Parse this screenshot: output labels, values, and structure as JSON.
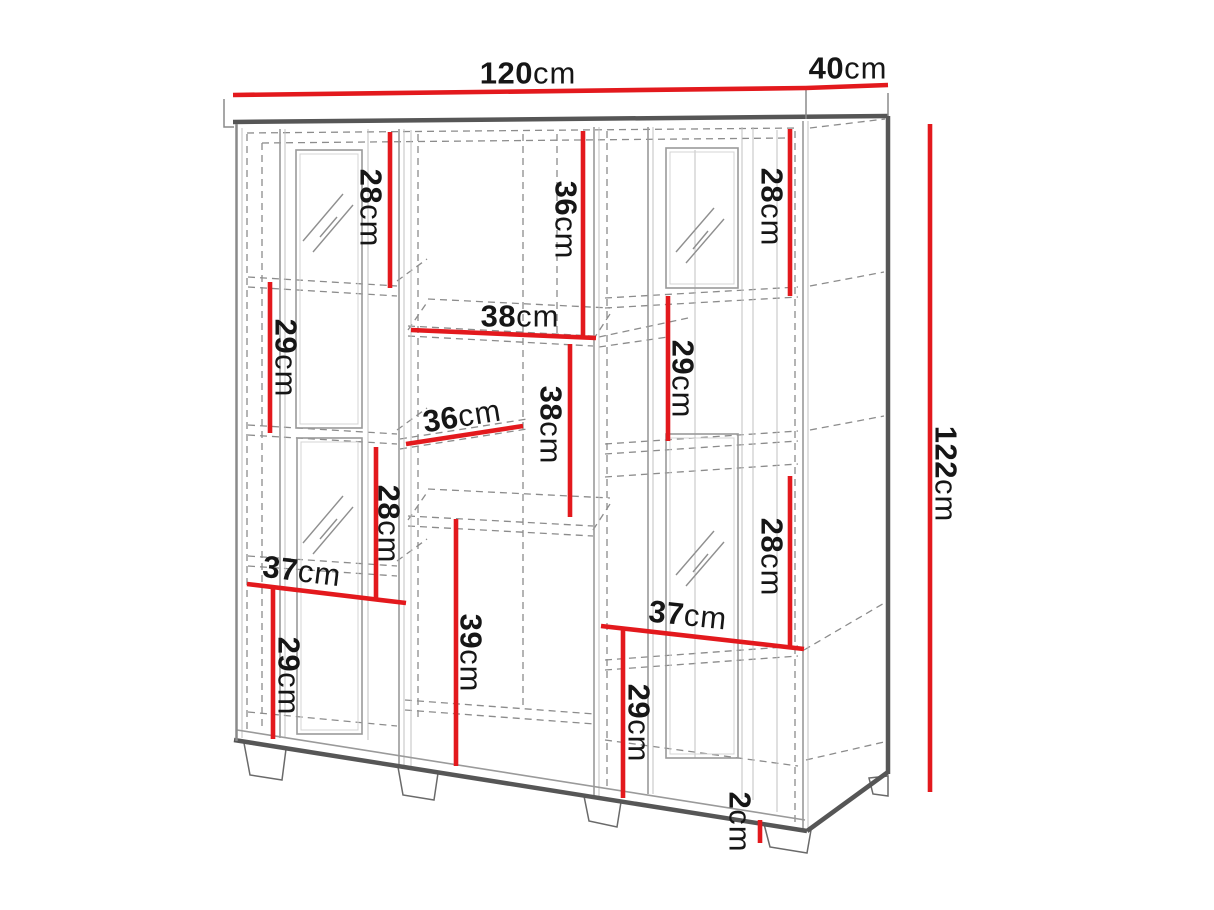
{
  "figure": {
    "type": "furniture-dimension-diagram",
    "background": "#ffffff",
    "accent_red": "#e3191d",
    "outline_gray": "#565656",
    "text_color": "#161616"
  },
  "dimensions": [
    {
      "id": "total-width",
      "value": "120",
      "unit": "cm",
      "orientation": "horizontal"
    },
    {
      "id": "depth",
      "value": "40",
      "unit": "cm",
      "orientation": "horizontal"
    },
    {
      "id": "total-height",
      "value": "122",
      "unit": "cm",
      "orientation": "vertical"
    },
    {
      "id": "left-top-compartment-height",
      "value": "28",
      "unit": "cm",
      "orientation": "vertical"
    },
    {
      "id": "left-second-compartment-height",
      "value": "29",
      "unit": "cm",
      "orientation": "vertical"
    },
    {
      "id": "center-top-compartment-height",
      "value": "36",
      "unit": "cm",
      "orientation": "vertical"
    },
    {
      "id": "center-shelf-width",
      "value": "38",
      "unit": "cm",
      "orientation": "horizontal"
    },
    {
      "id": "center-middle-compartment-height",
      "value": "38",
      "unit": "cm",
      "orientation": "vertical"
    },
    {
      "id": "center-lower-shelf-width",
      "value": "36",
      "unit": "cm",
      "orientation": "horizontal"
    },
    {
      "id": "left-third-compartment-height",
      "value": "28",
      "unit": "cm",
      "orientation": "vertical"
    },
    {
      "id": "left-section-width",
      "value": "37",
      "unit": "cm",
      "orientation": "horizontal"
    },
    {
      "id": "left-bottom-compartment-height",
      "value": "29",
      "unit": "cm",
      "orientation": "vertical"
    },
    {
      "id": "center-bottom-compartment-height",
      "value": "39",
      "unit": "cm",
      "orientation": "vertical"
    },
    {
      "id": "right-top-compartment-height",
      "value": "28",
      "unit": "cm",
      "orientation": "vertical"
    },
    {
      "id": "right-second-compartment-height",
      "value": "29",
      "unit": "cm",
      "orientation": "vertical"
    },
    {
      "id": "right-third-compartment-height",
      "value": "28",
      "unit": "cm",
      "orientation": "vertical"
    },
    {
      "id": "right-section-width",
      "value": "37",
      "unit": "cm",
      "orientation": "horizontal"
    },
    {
      "id": "right-bottom-compartment-height",
      "value": "29",
      "unit": "cm",
      "orientation": "vertical"
    },
    {
      "id": "foot-height",
      "value": "2",
      "unit": "cm",
      "orientation": "vertical"
    }
  ]
}
